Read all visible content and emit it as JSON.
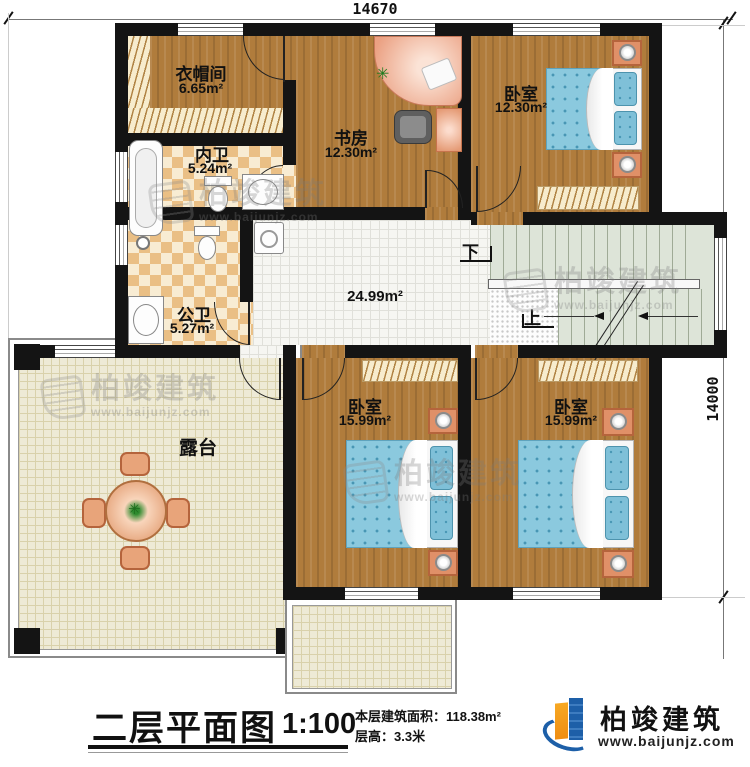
{
  "plan": {
    "dim_top": "14670",
    "dim_right": "14000",
    "rooms": [
      {
        "name": "衣帽间",
        "area": "6.65m²"
      },
      {
        "name": "内卫",
        "area": "5.24m²"
      },
      {
        "name": "书房",
        "area": "12.30m²"
      },
      {
        "name": "卧室",
        "area": "12.30m²"
      },
      {
        "name": "公卫",
        "area": "5.27m²"
      },
      {
        "name": "",
        "area": "24.99m²"
      },
      {
        "name": "卧室",
        "area": "15.99m²"
      },
      {
        "name": "卧室",
        "area": "15.99m²"
      },
      {
        "name": "露台",
        "area": ""
      }
    ],
    "stair_down": "下",
    "stair_up": "上"
  },
  "titleblock": {
    "title": "二层平面图",
    "scale": "1:100",
    "area_line": "本层建筑面积：118.38m²",
    "floor_height_line": "层高：3.3米"
  },
  "brand": {
    "name": "柏竣建筑",
    "url": "www.baijunjz.com"
  },
  "watermark": {
    "name": "柏竣建筑",
    "url": "www.baijunjz.com"
  },
  "colors": {
    "wall": "#141414",
    "wood": "#b07c3c",
    "bed": "#8bc9de",
    "accent_blue": "#1d5fa8",
    "accent_orange": "#f2a024"
  }
}
